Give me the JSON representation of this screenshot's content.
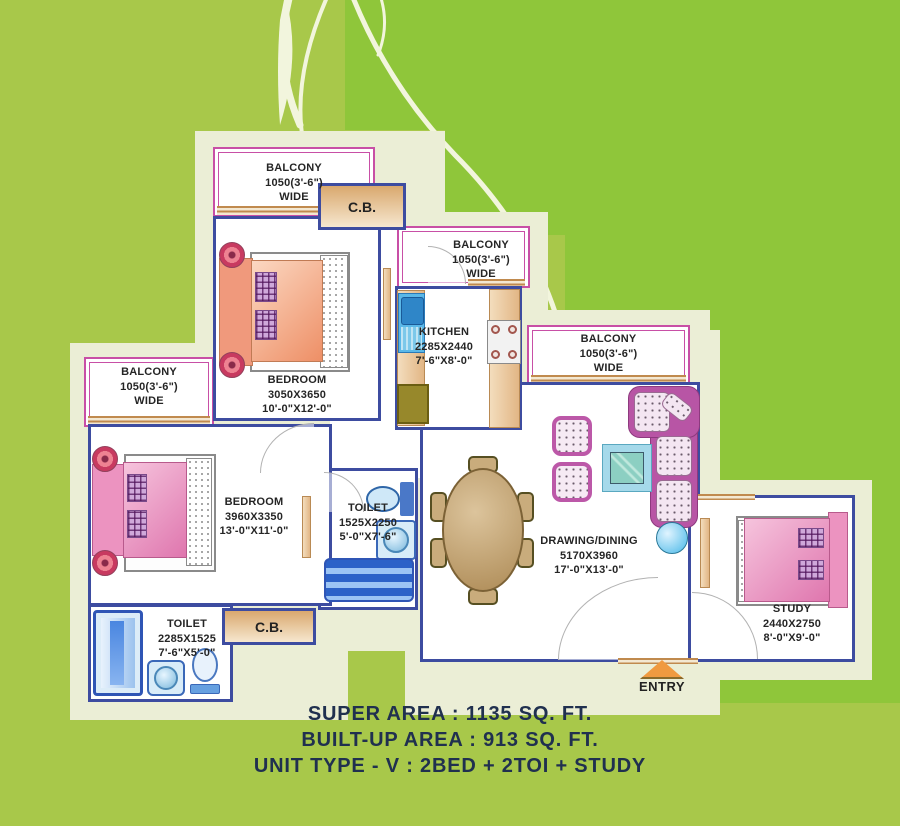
{
  "colors": {
    "background_green": "#a8c84a",
    "accent_green": "#8fc63a",
    "plan_cream": "#ebeed6",
    "wall_navy": "#3d4ca0",
    "balcony_pink": "#c84fa6",
    "bed_salmon": "#ee8f66",
    "bed_pink": "#df76ae",
    "counter_tan": "#e2b685",
    "water_blue": "#4a78c8",
    "entry_orange": "#f09a40",
    "footer_text": "#20304f"
  },
  "rooms": {
    "balcony_top": {
      "name": "BALCONY",
      "size": "1050(3'-6\")",
      "note": "WIDE"
    },
    "balcony_kitchen": {
      "name": "BALCONY",
      "size": "1050(3'-6\")",
      "note": "WIDE"
    },
    "balcony_right": {
      "name": "BALCONY",
      "size": "1050(3'-6\")",
      "note": "WIDE"
    },
    "balcony_left": {
      "name": "BALCONY",
      "size": "1050(3'-6\")",
      "note": "WIDE"
    },
    "cb_top": {
      "name": "C.B."
    },
    "cb_bottom": {
      "name": "C.B."
    },
    "bedroom_top": {
      "name": "BEDROOM",
      "mm": "3050X3650",
      "ft": "10'-0\"X12'-0\""
    },
    "bedroom_left": {
      "name": "BEDROOM",
      "mm": "3960X3350",
      "ft": "13'-0\"X11'-0\""
    },
    "kitchen": {
      "name": "KITCHEN",
      "mm": "2285X2440",
      "ft": "7'-6\"X8'-0\""
    },
    "toilet_mid": {
      "name": "TOILET",
      "mm": "1525X2250",
      "ft": "5'-0\"X7'-6\""
    },
    "toilet_bottom": {
      "name": "TOILET",
      "mm": "2285X1525",
      "ft": "7'-6\"X5'-0\""
    },
    "drawing_dining": {
      "name": "DRAWING/DINING",
      "mm": "5170X3960",
      "ft": "17'-0\"X13'-0\""
    },
    "study": {
      "name": "STUDY",
      "mm": "2440X2750",
      "ft": "8'-0\"X9'-0\""
    }
  },
  "entry": {
    "label": "ENTRY"
  },
  "footer": {
    "super_area": "SUPER AREA : 1135 SQ. FT.",
    "built_up_area": "BUILT-UP AREA :  913 SQ. FT.",
    "unit_type": "UNIT TYPE - V :  2BED + 2TOI + STUDY"
  }
}
